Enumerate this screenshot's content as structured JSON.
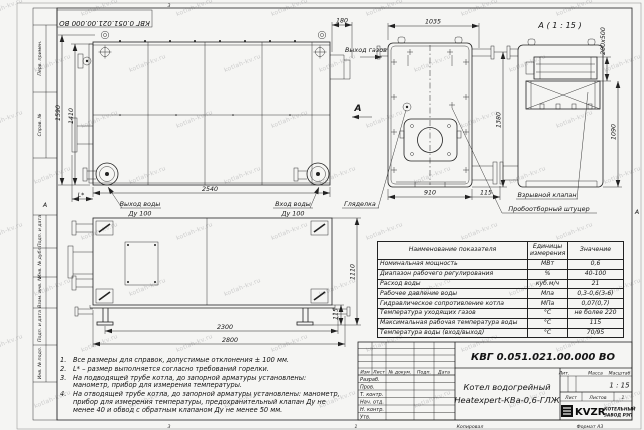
{
  "watermark": "kotlah-kv.ru",
  "stamp_doc_number": "КВГ 0.051.021.00.000 ВО",
  "frame": {
    "left_cells": [
      "Перв. примен.",
      "Справ. №",
      "Подп. и дата",
      "Инв. № дубл.",
      "Взам. инв. №",
      "Подп. и дата",
      "Инв. № подл."
    ],
    "zone_a_left": "А",
    "zone_a_right": "А",
    "zone_num_top": "3",
    "zone_num_bottom": "3",
    "sheet_num_bottom": "1",
    "copy_label": "Копировал",
    "format_label": "Формат А3"
  },
  "front_view": {
    "dim_height_total": "1590",
    "dim_height_body": "1410",
    "dim_gas_offset": "180",
    "dim_length": "2540",
    "dim_l_star": "L*",
    "label_water_out_1": "Выход воды",
    "label_water_out_2": "Ду 100",
    "label_water_in_1": "Вход воды",
    "label_water_in_2": "Ду 100",
    "label_gas_out": "Выход газов",
    "section_letter": "А"
  },
  "side_view": {
    "dim_width_top": "1035",
    "dim_width_body": "910",
    "dim_stub": "115",
    "dim_height": "1380",
    "label_sight_glass": "Гляделка",
    "label_sampling": "Пробоотборный штуцер"
  },
  "view_a": {
    "title": "А ( 1 : 15 )",
    "dim_valve": "200x500",
    "dim_height": "1090",
    "label_explosion_valve": "Взрывной клапан"
  },
  "plan_view": {
    "dim_length_inner": "2300",
    "dim_length_total": "2800",
    "dim_height": "1110",
    "dim_support": "115"
  },
  "notes": [
    {
      "num": "1.",
      "text": "Все размеры для справок, допустимые отклонения ± 100 мм."
    },
    {
      "num": "2.",
      "text": "L* – размер выполняется согласно требований горелки."
    },
    {
      "num": "3.",
      "text": "На подводящей трубе котла, до запорной арматуры установлены: манометр, прибор для измерения температуры."
    },
    {
      "num": "4.",
      "text": "На отводящей трубе котла, до запорной арматуры установлены: манометр, прибор для измерения температуры, предохранительный клапан Ду не менее 40 и обвод с обратным клапаном Ду не менее 50 мм."
    }
  ],
  "spec_table": {
    "col_name": "Наименование показателя",
    "col_units_1": "Единицы",
    "col_units_2": "измерения",
    "col_value": "Значение",
    "rows": [
      {
        "name": "Номинальная мощность",
        "units": "МВт",
        "value": "0,6"
      },
      {
        "name": "Диапазон рабочего регулирования",
        "units": "%",
        "value": "40-100"
      },
      {
        "name": "Расход воды",
        "units": "куб.м/ч",
        "value": "21"
      },
      {
        "name": "Рабочее давление воды",
        "units": "Мпа",
        "value": "0,3-0,6(3-6)"
      },
      {
        "name": "Гидравлическое сопротивление котла",
        "units": "МПа",
        "value": "0,07(0,7)"
      },
      {
        "name": "Температура уходящих газов",
        "units": "°С",
        "value": "не более 220"
      },
      {
        "name": "Максимальная рабочая температура воды",
        "units": "°С",
        "value": "115"
      },
      {
        "name": "Температура воды (вход/выход)",
        "units": "°С",
        "value": "70/95"
      }
    ]
  },
  "title_block": {
    "doc_number": "КВГ 0.051.021.00.000 ВО",
    "name_line1": "Котел водогрейный",
    "name_line2": "Heatexpert-КВа-0,6-ГЛЖ",
    "col_izm": "Изм",
    "col_list": "Лист",
    "col_docnum": "№ докум.",
    "col_podp": "Подп.",
    "col_data": "Дата",
    "row_labels": [
      "Разраб.",
      "Пров.",
      "Т. контр.",
      "Нач. отд.",
      "Н. контр.",
      "Утв."
    ],
    "lit_label": "Лит.",
    "mass_label": "Масса",
    "scale_label": "Масштаб",
    "scale_value": "1 : 15",
    "sheet_label": "Лист",
    "sheets_label": "Листов",
    "sheets_value": "1",
    "logo_text": "KVZR",
    "company_line1": "КОТЕЛЬНЫЙ",
    "company_line2": "ЗАВОД РЭП"
  }
}
